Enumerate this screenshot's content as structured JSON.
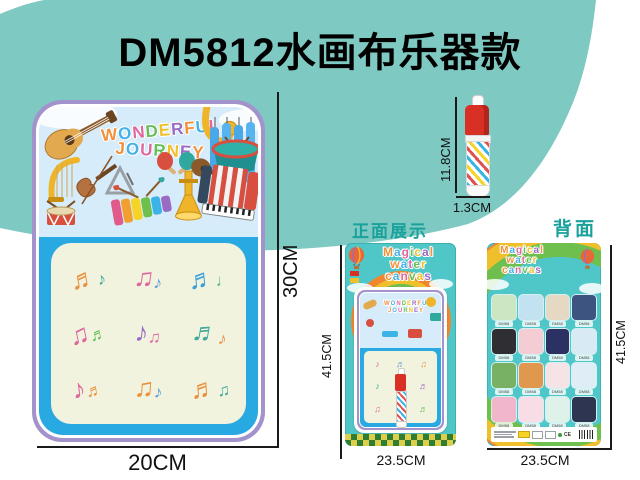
{
  "page": {
    "title": "DM5812水画布乐器款",
    "background_color": "#7fc9c3",
    "accent_color": "#18a29b"
  },
  "mat": {
    "banner_line1": "WONDERFUL",
    "banner_line2": "JOURNEY",
    "height_label": "30CM",
    "width_label": "20CM",
    "instrument_icons": [
      "guitar-icon",
      "saxophone-icon",
      "piano-keys-icon",
      "steel-drum-icon",
      "maracas-icon",
      "ukulele-icon",
      "harp-icon",
      "violin-icon",
      "triangle-icon",
      "xylophone-icon",
      "trumpet-icon",
      "accordion-icon",
      "snare-drum-icon"
    ],
    "doodles": [
      {
        "g1": "♬",
        "c1": "#e8923f",
        "g2": "♪",
        "c2": "#3fa99b",
        "rot": -10
      },
      {
        "g1": "♫",
        "c1": "#e0679e",
        "g2": "♪",
        "c2": "#5b9bd5",
        "rot": 8
      },
      {
        "g1": "♬",
        "c1": "#3a9fd6",
        "g2": "♩",
        "c2": "#56b68b",
        "rot": -6
      },
      {
        "g1": "♫",
        "c1": "#e0679e",
        "g2": "♬",
        "c2": "#67bd57",
        "rot": -12
      },
      {
        "g1": "♪",
        "c1": "#9a6bc4",
        "g2": "♫",
        "c2": "#e0679e",
        "rot": 6
      },
      {
        "g1": "♬",
        "c1": "#3fa99b",
        "g2": "♪",
        "c2": "#e8923f",
        "rot": 10
      },
      {
        "g1": "♪",
        "c1": "#e0679e",
        "g2": "♬",
        "c2": "#e8923f",
        "rot": -8
      },
      {
        "g1": "♫",
        "c1": "#e8923f",
        "g2": "♪",
        "c2": "#5b9bd5",
        "rot": 4
      },
      {
        "g1": "♬",
        "c1": "#e8923f",
        "g2": "♫",
        "c2": "#3fa99b",
        "rot": -5
      }
    ]
  },
  "pen": {
    "height_label": "11.8CM",
    "width_label": "1.3CM",
    "cap_color": "#d93025"
  },
  "front_package": {
    "section_label": "正面展示",
    "brand_line1": "Magical",
    "brand_line2": "water",
    "brand_line3": "canvas",
    "inner_banner_line1": "WONDERFUL",
    "inner_banner_line2": "JOURNEY",
    "height_label": "41.5CM",
    "width_label": "23.5CM",
    "mini_doodles": [
      {
        "g": "♪",
        "c": "#e0679e"
      },
      {
        "g": "♬",
        "c": "#5b9bd5"
      },
      {
        "g": "♫",
        "c": "#e8923f"
      },
      {
        "g": "♪",
        "c": "#3fa99b"
      },
      {
        "g": "",
        "c": "#000000"
      },
      {
        "g": "♬",
        "c": "#9a6bc4"
      },
      {
        "g": "♫",
        "c": "#e0679e"
      },
      {
        "g": "♪",
        "c": "#e8923f"
      },
      {
        "g": "♬",
        "c": "#67bd57"
      }
    ]
  },
  "back_package": {
    "section_label": "背面",
    "brand_line1": "Magical",
    "brand_line2": "water",
    "brand_line3": "canvas",
    "height_label": "41.5CM",
    "width_label": "23.5CM",
    "cert_text": "CE",
    "variants": [
      {
        "label": "DM58",
        "bg": "#cde6c2"
      },
      {
        "label": "DM58",
        "bg": "#c2e2f2"
      },
      {
        "label": "DM58",
        "bg": "#e6d9c4"
      },
      {
        "label": "DM58",
        "bg": "#3d5380"
      },
      {
        "label": "DM58",
        "bg": "#2f2f33"
      },
      {
        "label": "DM58",
        "bg": "#f3cdd3"
      },
      {
        "label": "DM58",
        "bg": "#2c3163"
      },
      {
        "label": "DM58",
        "bg": "#d8eaf4"
      },
      {
        "label": "DM58",
        "bg": "#79b164"
      },
      {
        "label": "DM58",
        "bg": "#e0984f"
      },
      {
        "label": "DM58",
        "bg": "#f6e3e6"
      },
      {
        "label": "DM58",
        "bg": "#dfeef6"
      },
      {
        "label": "DM58",
        "bg": "#f1b6cb"
      },
      {
        "label": "DM58",
        "bg": "#f8dde7"
      },
      {
        "label": "DM58",
        "bg": "#dff2ea"
      },
      {
        "label": "DM58",
        "bg": "#2e3550"
      }
    ]
  }
}
